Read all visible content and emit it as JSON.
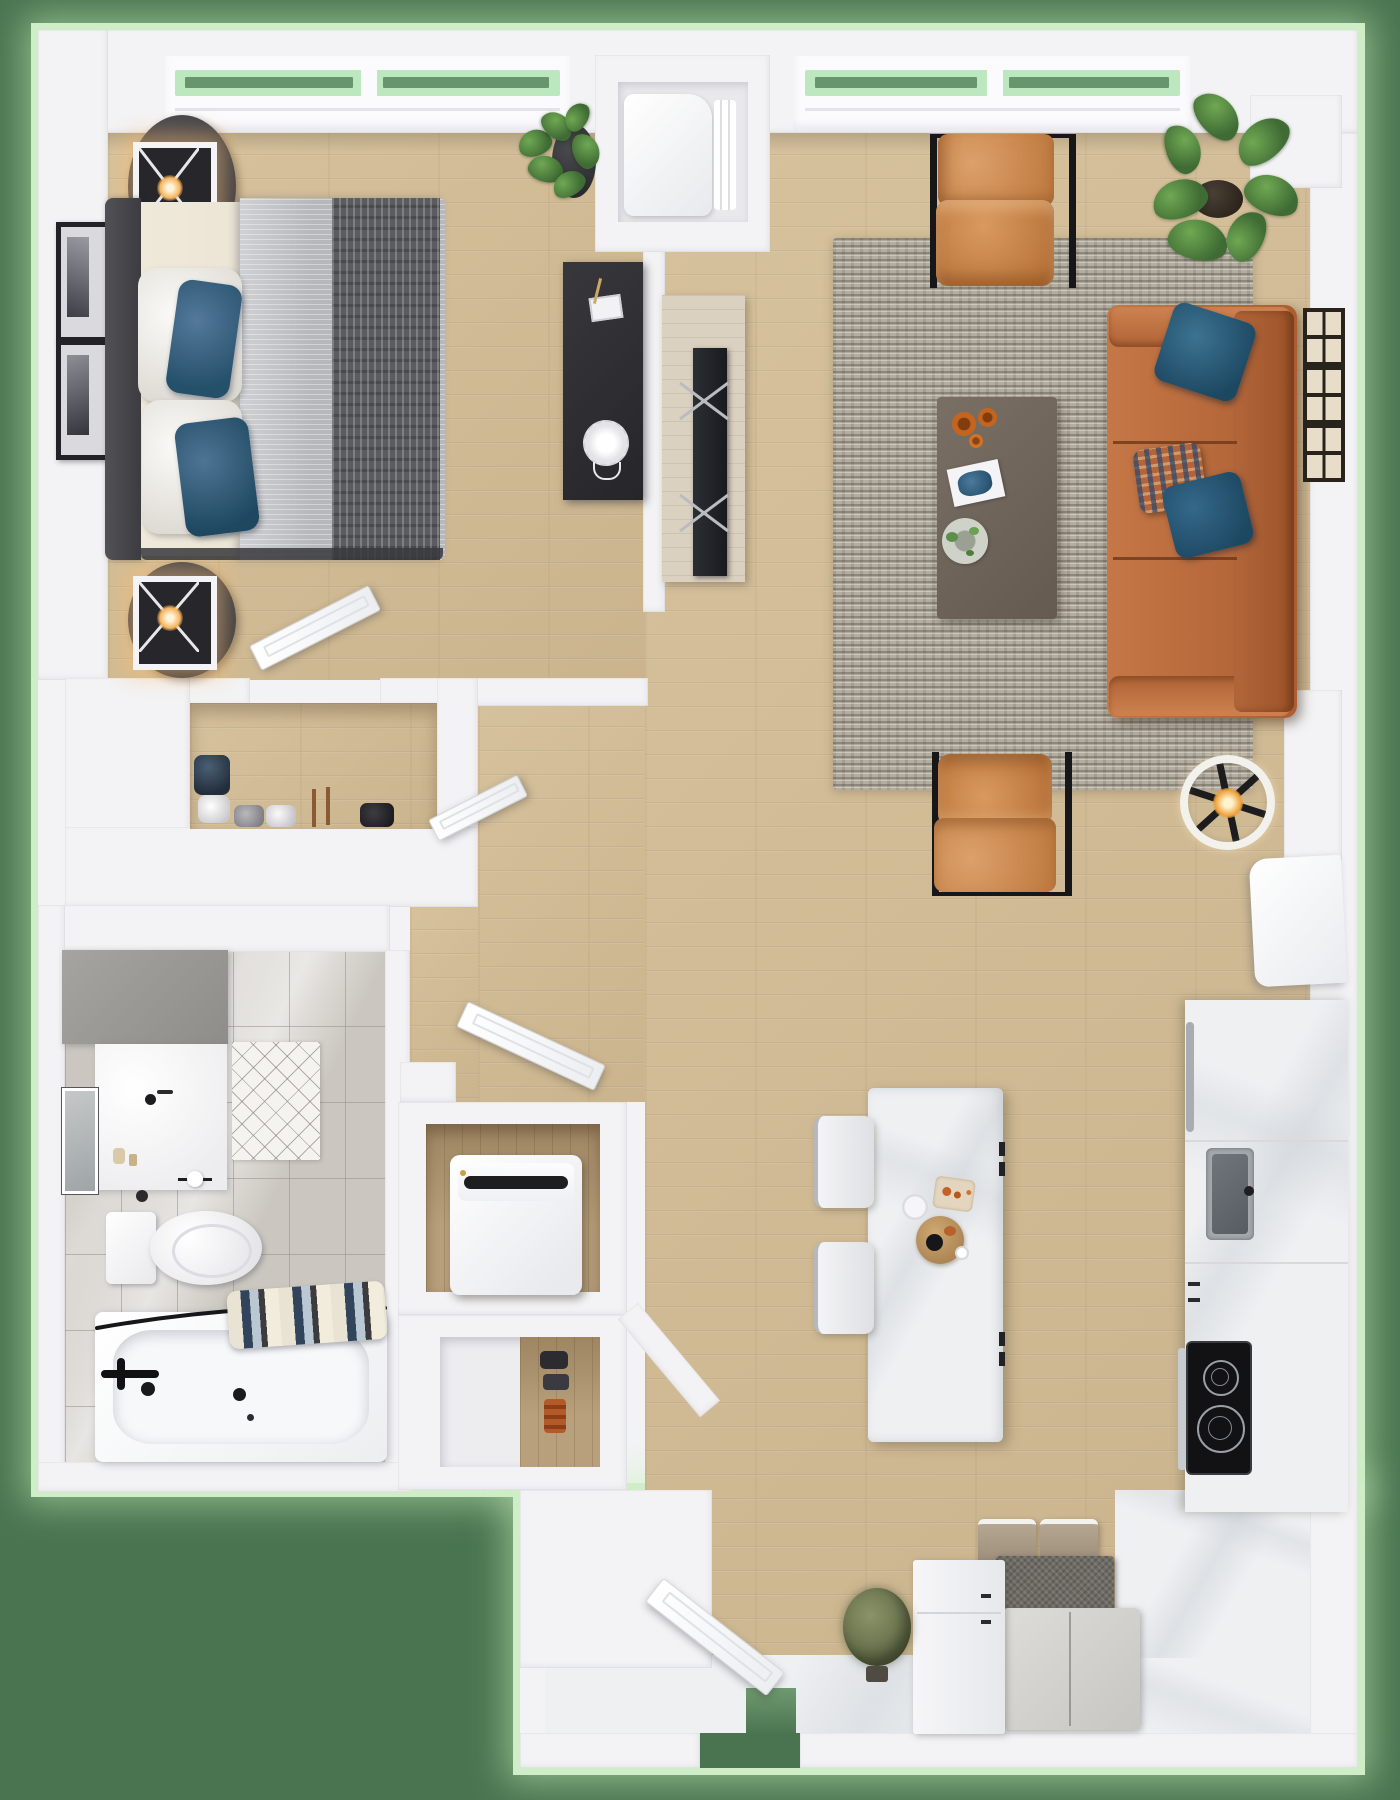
{
  "scene": {
    "type": "3d_floor_plan_render",
    "view": "top_down",
    "width_px": 1400,
    "height_px": 1800,
    "unit_layout": "one_bedroom_apartment",
    "visible_text": []
  },
  "palette": {
    "bg": "#4a7450",
    "glow": "#cfeec8",
    "wall": "#f3f3f5",
    "glass": "#bde7bf",
    "wood": "#d3bd96",
    "tile": "#cbc7c0",
    "marble": "#eef0f2",
    "rug": "#b4aea1",
    "leather": "#b8683a",
    "chair_orange": "#cd8d55",
    "pillow_blue": "#24506a",
    "duvet_gray": "#b7b8bc",
    "throw_gray": "#5b5c60",
    "headboard": "#46464a",
    "desk_black": "#2f2f33",
    "table_dark": "#6f6359",
    "cooktop_black": "#121214",
    "steel": "#a2a8ac",
    "bench_felt": "#a3947f",
    "bench_dark": "#6e6a64",
    "shrub_olive": "#6f7a52"
  },
  "rooms": {
    "bedroom": {
      "name": "bedroom",
      "furniture": [
        "double-bed",
        "headboard",
        "white-pillows",
        "blue-accent-pillows",
        "gray-duvet",
        "dark-throw-blanket",
        "nightstand-with-cube-lamp-top",
        "nightstand-with-cube-lamp-bottom",
        "wall-frames-pair",
        "potted-plant",
        "black-desk",
        "window-bay"
      ]
    },
    "living_room": {
      "name": "living-room",
      "furniture": [
        "leather-sofa",
        "blue-throw-pillows",
        "patterned-pillow",
        "gray-shag-rug",
        "coffee-table",
        "orange-bowls",
        "magazine",
        "decor-plate",
        "tufted-lounge-chair-north",
        "tufted-lounge-chair-south",
        "monstera-plant",
        "ceiling-fan-with-light",
        "tv-console",
        "tv",
        "gallery-frames-right-wall",
        "window-bay"
      ]
    },
    "utility_niche": {
      "name": "utility-closet",
      "furniture": [
        "water-heater"
      ]
    },
    "bedroom_closet": {
      "name": "reach-in-closet",
      "furniture": [
        "shoe-rows"
      ]
    },
    "bathroom": {
      "name": "bathroom",
      "furniture": [
        "vanity-with-sink",
        "mirror",
        "toilet",
        "toilet-paper-holder",
        "diamond-bath-mat",
        "bathtub",
        "black-faucet-set",
        "shower-rod",
        "striped-towels"
      ]
    },
    "laundry_closet": {
      "name": "laundry-closet",
      "furniture": [
        "top-load-washer"
      ]
    },
    "shoe_closet": {
      "name": "lower-closet",
      "furniture": [
        "shoes"
      ]
    },
    "kitchen": {
      "name": "kitchen",
      "furniture": [
        "refrigerator",
        "counter-run",
        "stainless-sink",
        "electric-cooktop",
        "oven-handle",
        "marble-island",
        "island-food-props",
        "white-stool-pair"
      ]
    },
    "entry": {
      "name": "entry",
      "furniture": [
        "entry-door-ajar",
        "storage-bench-felt-boxes",
        "woven-gray-box",
        "bench-cushion",
        "white-cabinet",
        "potted-shrub"
      ]
    }
  },
  "windows": {
    "count": 2,
    "style": "transom-bay",
    "glass_view": "green-lawn"
  },
  "doors": {
    "count": 5,
    "state": "ajar",
    "positions": [
      "bedroom",
      "hallway",
      "bathroom",
      "entry",
      "closet"
    ]
  }
}
